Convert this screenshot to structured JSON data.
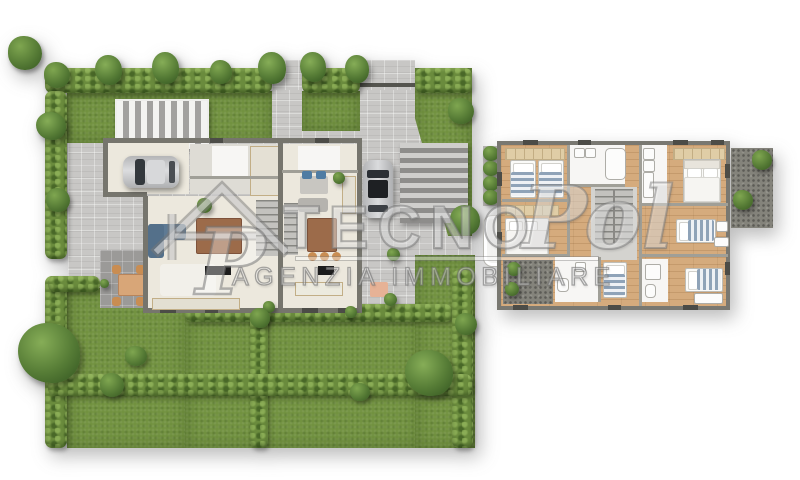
{
  "watermark": {
    "brand_prefix": "TECNO",
    "brand_script": "Pol",
    "logo_letter": "P",
    "tagline": "AGENZIA IMMOBILIARE",
    "color": "#8c8c8c"
  },
  "plans": {
    "ground_floor": {
      "name": "ground floor with garden",
      "features": [
        "perimeter hedge",
        "lawn",
        "trees and shrubs",
        "paved courtyard",
        "driveway",
        "patio dining set",
        "semi-detached house with two units",
        "car in garage",
        "car on parking pad",
        "slatted pergola",
        "slatted carport",
        "living and dining rooms",
        "staircases",
        "bathrooms"
      ]
    },
    "upper_floor": {
      "name": "upper floor",
      "features": [
        "twin bedroom",
        "double bedroom",
        "master bedroom",
        "single bedrooms",
        "bathrooms",
        "staircase",
        "terrace with plants",
        "balcony planters",
        "wood flooring"
      ]
    }
  },
  "colors": {
    "lawn": "#71913f",
    "hedge": "#6a8b3d",
    "tree": "#4a7030",
    "paving_light": "#c8c7c5",
    "paving_dark": "#9b9a98",
    "wall": "#76756d",
    "floor_cream": "#ece8dd",
    "floor_white": "#f7f6f4",
    "wood_floor": "#d5ab7d",
    "terrace": "#84837b",
    "bed_stripe_blue": "#8fa3b8",
    "dining_table_wood": "#9c6b4a",
    "sofa_blue": "#5e7a94",
    "car_silver": "#c9cacc",
    "car_roof_dark": "#1e2023",
    "tv_black": "#1c1c1c",
    "watermark_gray": "#8c8c8c"
  }
}
